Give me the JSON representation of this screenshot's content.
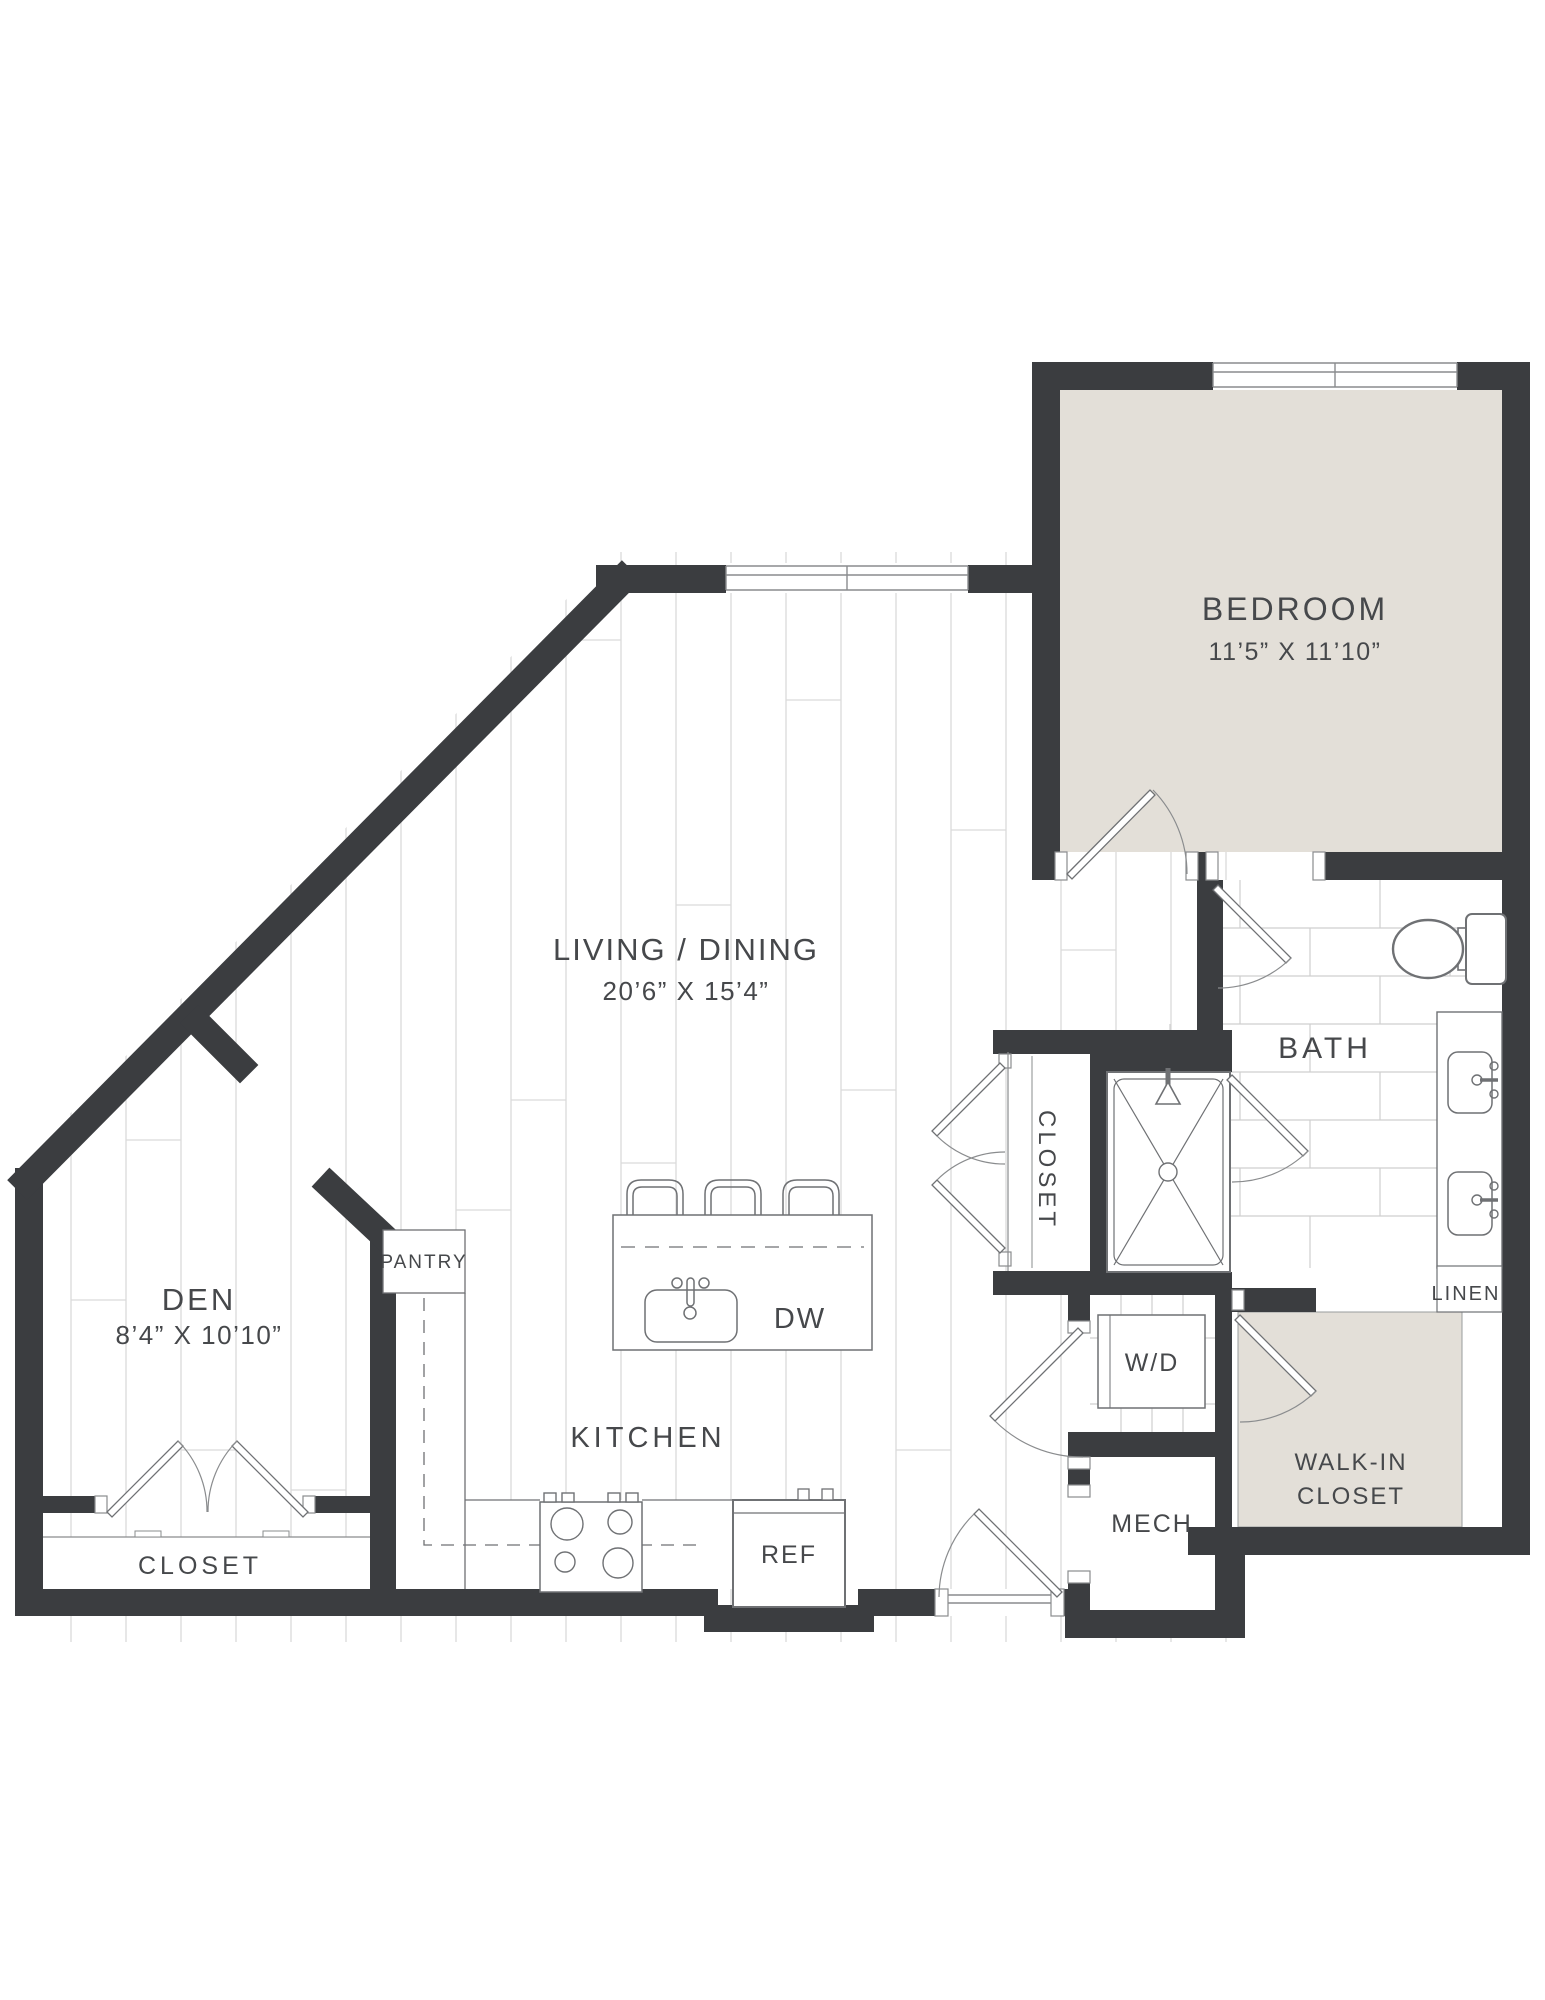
{
  "title": "One Bedroom + Den Floor Plan",
  "colors": {
    "wall": "#3b3d40",
    "room_fill": "#e3dfd8",
    "plank_line": "#d9d9d9",
    "tile_line": "#cfcfcf",
    "fixture_line": "#6f7174",
    "label_text": "#46484b"
  },
  "rooms": {
    "bedroom": {
      "name": "BEDROOM",
      "dims": "11’5” X 11’10”"
    },
    "living": {
      "name": "LIVING / DINING",
      "dims": "20’6” X 15’4”"
    },
    "den": {
      "name": "DEN",
      "dims": "8’4” X 10’10”"
    },
    "kitchen": {
      "name": "KITCHEN"
    },
    "bath": {
      "name": "BATH"
    },
    "hall_closet": {
      "name": "CLOSET"
    },
    "den_closet": {
      "name": "CLOSET"
    },
    "walk_in_closet": {
      "line1": "WALK-IN",
      "line2": "CLOSET"
    },
    "pantry": {
      "name": "PANTRY"
    },
    "laundry": {
      "name": "W/D"
    },
    "mech": {
      "name": "MECH"
    },
    "linen": {
      "name": "LINEN"
    }
  },
  "appliances": {
    "refrigerator": "REF",
    "dishwasher": "DW"
  }
}
